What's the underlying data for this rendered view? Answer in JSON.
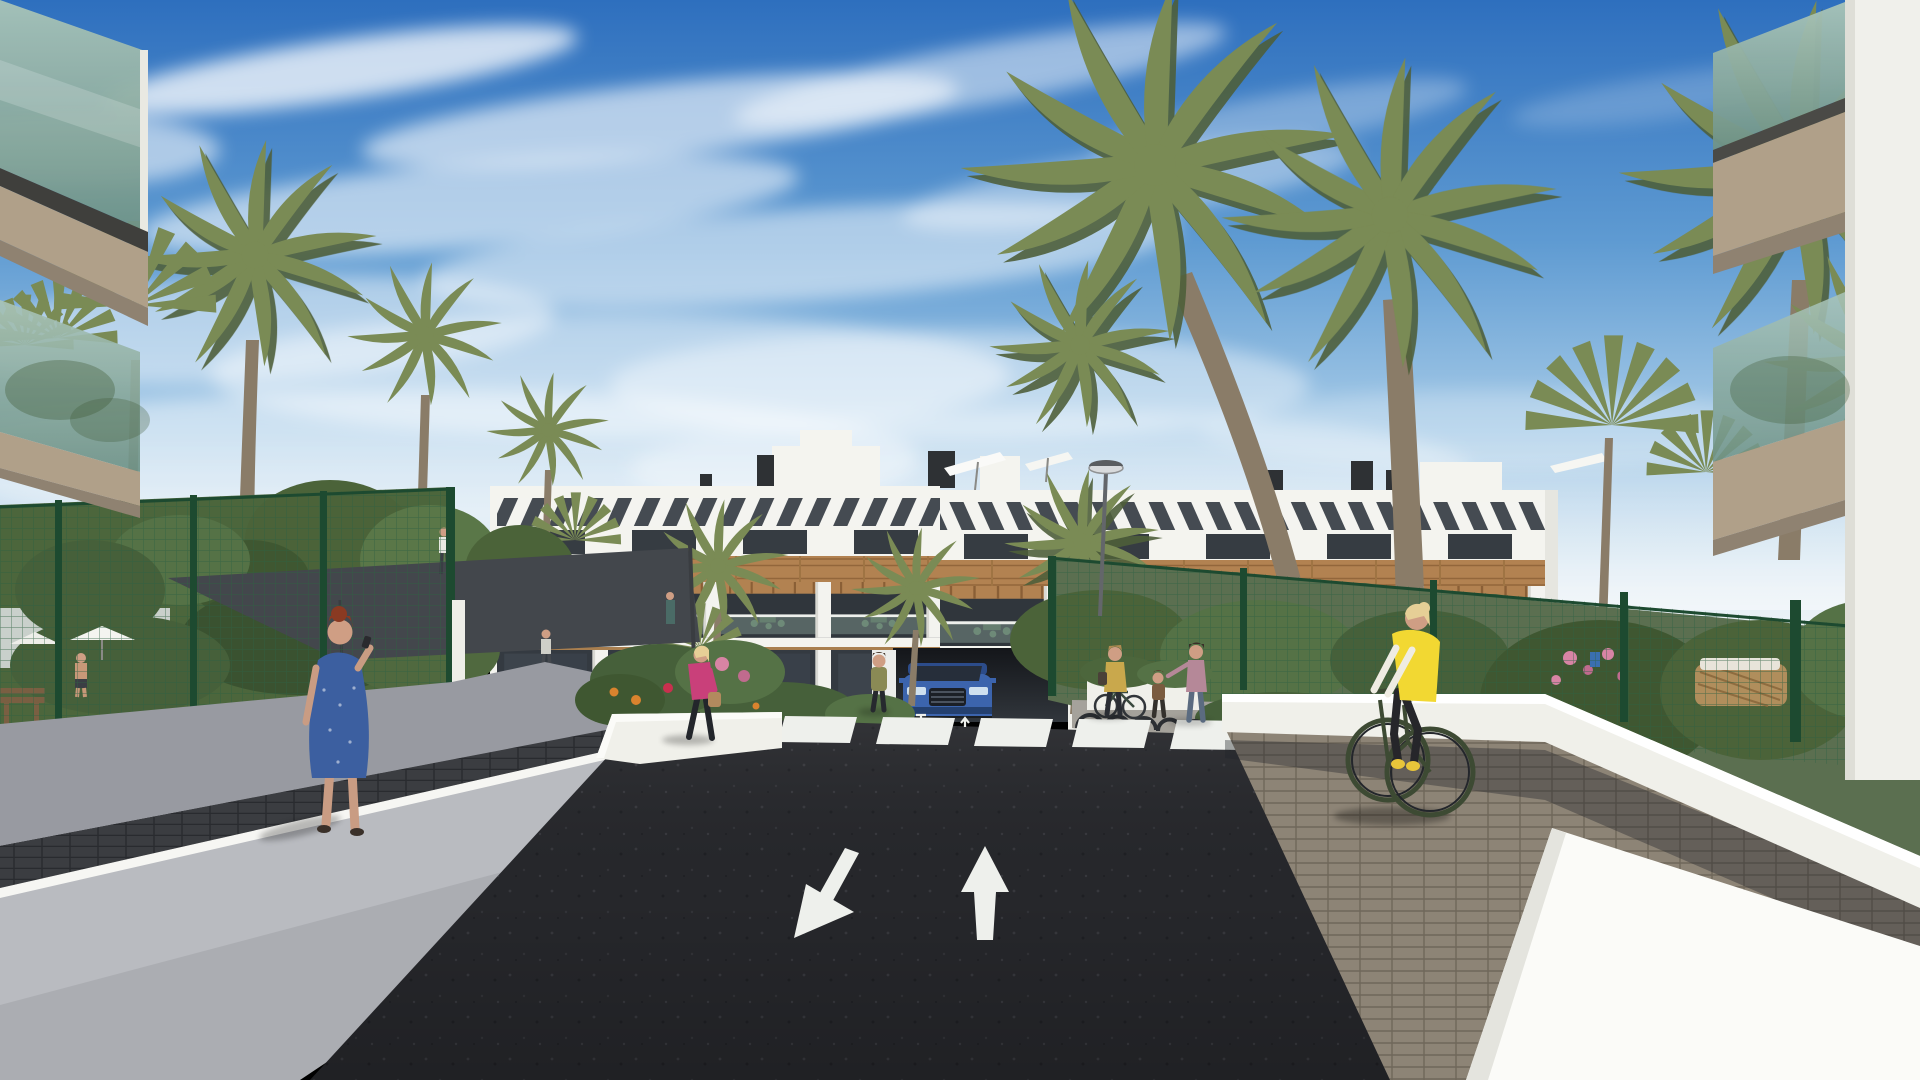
{
  "scene": {
    "type": "architectural-render",
    "objects": [
      "modern white apartment building with rooftop pergolas",
      "wood cladding band and terraces with green furniture",
      "underground parking ramp with blue suv",
      "asphalt road with zebra crosswalk and two lane arrows",
      "green mesh fences with gardens and dark shade sail",
      "palm trees",
      "glass balconies in foreground corners",
      "low white walls and paver walkways"
    ],
    "road": {
      "crosswalk_stripes": 7,
      "lane_arrows": [
        "down-left",
        "up"
      ],
      "ramp_arrows": [
        "down",
        "up"
      ]
    },
    "people": [
      "woman with red hair in blue polka-dot dress on phone",
      "woman in magenta jacket with handbag",
      "woman standing beside car",
      "woman with parked bicycle and shoulder bag",
      "child",
      "woman in mauve floral top",
      "cyclist in yellow vest on green bicycle",
      "man in garden",
      "distant pedestrians"
    ],
    "vehicles": [
      "blue suv exiting garage ramp",
      "parked bicycle",
      "green bicycle"
    ],
    "palette": {
      "sky_top": "#2e6fbe",
      "sky_horizon": "#e8f0f6",
      "cloud_white": "#ffffff",
      "building_white": "#f4f4ef",
      "wood_cladding": "#b28251",
      "window_dark": "#363c42",
      "pergola_shadow": "#454b52",
      "pergola_slat_white": "#f4f4f0",
      "terrace_glass": "#7d948c",
      "fence_green": "#2f6243",
      "post_green": "#1d4a30",
      "palm_green": "#7a8b55",
      "palm_dark": "#4f5f3a",
      "trunk_brown": "#8a7c68",
      "foliage": "#4c663c",
      "flower_pink": "#d884a4",
      "flower_orange": "#d9832e",
      "asphalt": "#26272b",
      "road_marking": "#eef0ec",
      "sidewalk_gray": "#989aa1",
      "retaining_wall_gray": "#b9bbc0",
      "paver_dark": "#3b3d41",
      "paver_brown": "#8d8476",
      "wall_white": "#f0f0ea",
      "wall_sunlit": "#fbfbf8",
      "shade_sail": "#43474c",
      "car_blue": "#3c64ad",
      "vest_yellow": "#f2d832",
      "dress_blue": "#3c5fa0",
      "jacket_pink": "#c9407a",
      "skin": "#cf9e84",
      "hair_red": "#8a3a22",
      "hair_blonde": "#e6cf96",
      "bicycle_green": "#3d4a33",
      "balcony_glass": "#8fb0a4",
      "slab_tan": "#b0a089"
    }
  }
}
